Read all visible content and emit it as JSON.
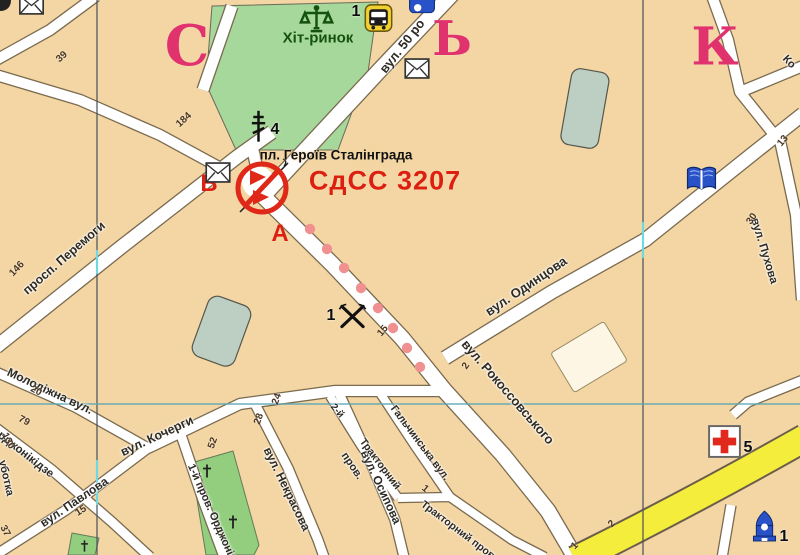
{
  "map": {
    "code_label": "СдСС 3207",
    "point_letters": {
      "a": "А",
      "b": "В"
    },
    "square_label": "пл. Героїв Сталінграда",
    "market_label": "Хіт-ринок",
    "grid_letters": [
      {
        "text": "С",
        "x": 187,
        "y": 46,
        "size": 56
      },
      {
        "text": "Ь",
        "x": 452,
        "y": 39,
        "size": 48
      },
      {
        "text": "К",
        "x": 715,
        "y": 47,
        "size": 52
      }
    ],
    "street_labels": [
      {
        "text": "вул. 50 ро",
        "x": 402,
        "y": 46,
        "rot": -52,
        "size": 13
      },
      {
        "text": "вул. Одинцова",
        "x": 526,
        "y": 286,
        "rot": -34,
        "size": 13
      },
      {
        "text": "вул. Рокоссовського",
        "x": 508,
        "y": 392,
        "rot": 49,
        "size": 13
      },
      {
        "text": "просп. Перемоги",
        "x": 64,
        "y": 258,
        "rot": -41,
        "size": 12.5
      },
      {
        "text": "Молодіжна вул.",
        "x": 50,
        "y": 391,
        "rot": 25,
        "size": 12
      },
      {
        "text": "вул. Кочерги",
        "x": 157,
        "y": 436,
        "rot": -25,
        "size": 12.5
      },
      {
        "text": "вул. Павлова",
        "x": 74,
        "y": 502,
        "rot": -34,
        "size": 12
      },
      {
        "text": "Орджонікідзе",
        "x": 22,
        "y": 452,
        "rot": 38,
        "size": 11.5
      },
      {
        "text": "уботка",
        "x": 6,
        "y": 478,
        "rot": 77,
        "size": 11
      },
      {
        "text": "1-й пров. Орджонікідзе",
        "x": 216,
        "y": 522,
        "rot": 66,
        "size": 11
      },
      {
        "text": "вул. Некрасова",
        "x": 287,
        "y": 489,
        "rot": 64,
        "size": 12
      },
      {
        "text": "вул. Осипова",
        "x": 381,
        "y": 487,
        "rot": 65,
        "size": 12
      },
      {
        "text": "пров.",
        "x": 352,
        "y": 466,
        "rot": 56,
        "size": 11
      },
      {
        "text": "2-й",
        "x": 337,
        "y": 411,
        "rot": 50,
        "size": 10
      },
      {
        "text": "Тракторний",
        "x": 380,
        "y": 464,
        "rot": 53,
        "size": 10.5
      },
      {
        "text": "Гальчинська вул.",
        "x": 420,
        "y": 443,
        "rot": 53,
        "size": 10.5
      },
      {
        "text": "Тракторний пров.",
        "x": 459,
        "y": 531,
        "rot": 37,
        "size": 10.5
      },
      {
        "text": "вул. Пухова",
        "x": 764,
        "y": 251,
        "rot": 73,
        "size": 11.5
      },
      {
        "text": "Ко",
        "x": 789,
        "y": 62,
        "rot": 47,
        "size": 11
      }
    ],
    "house_numbers": [
      {
        "text": "39",
        "x": 62,
        "y": 57,
        "rot": -42
      },
      {
        "text": "184",
        "x": 184,
        "y": 120,
        "rot": -42
      },
      {
        "text": "146",
        "x": 17,
        "y": 269,
        "rot": -47
      },
      {
        "text": "20",
        "x": 36,
        "y": 391,
        "rot": 28
      },
      {
        "text": "79",
        "x": 24,
        "y": 421,
        "rot": 28
      },
      {
        "text": "130",
        "x": 8,
        "y": 441,
        "rot": 62
      },
      {
        "text": "37",
        "x": 5,
        "y": 531,
        "rot": 62
      },
      {
        "text": "15",
        "x": 81,
        "y": 511,
        "rot": -33
      },
      {
        "text": "24",
        "x": 277,
        "y": 399,
        "rot": -70
      },
      {
        "text": "28",
        "x": 259,
        "y": 419,
        "rot": -70
      },
      {
        "text": "52",
        "x": 213,
        "y": 443,
        "rot": -70
      },
      {
        "text": "15",
        "x": 383,
        "y": 331,
        "rot": -50
      },
      {
        "text": "2",
        "x": 466,
        "y": 366,
        "rot": -55
      },
      {
        "text": "30",
        "x": 752,
        "y": 219,
        "rot": -55
      },
      {
        "text": "13",
        "x": 783,
        "y": 141,
        "rot": -50
      },
      {
        "text": "2",
        "x": 612,
        "y": 524,
        "rot": -45
      },
      {
        "text": "1",
        "x": 575,
        "y": 546,
        "rot": -45
      },
      {
        "text": "1",
        "x": 425,
        "y": 489,
        "rot": 40
      }
    ],
    "poi_numbers": [
      {
        "text": "1",
        "x": 356,
        "y": 12
      },
      {
        "text": "4",
        "x": 275,
        "y": 130
      },
      {
        "text": "1",
        "x": 331,
        "y": 316
      },
      {
        "text": "5",
        "x": 748,
        "y": 448
      },
      {
        "text": "1",
        "x": 784,
        "y": 537
      }
    ],
    "icons": [
      {
        "name": "corner-symbol-fragment-icon",
        "sym": "frag",
        "x": 0,
        "y": 0,
        "w": 14,
        "h": 12
      },
      {
        "name": "envelope-icon",
        "sym": "envelope",
        "x": 19,
        "y": -6,
        "w": 25,
        "h": 21
      },
      {
        "name": "scales-icon",
        "sym": "scales",
        "x": 299,
        "y": 5,
        "w": 35,
        "h": 29
      },
      {
        "name": "bus-icon",
        "sym": "bus",
        "x": 364,
        "y": 4,
        "w": 29,
        "h": 28
      },
      {
        "name": "transit-icon",
        "sym": "transit",
        "x": 409,
        "y": -5,
        "w": 26,
        "h": 19
      },
      {
        "name": "envelope-icon",
        "sym": "envelope",
        "x": 404,
        "y": 58,
        "w": 26,
        "h": 21
      },
      {
        "name": "envelope-icon",
        "sym": "envelope",
        "x": 205,
        "y": 162,
        "w": 26,
        "h": 21
      },
      {
        "name": "church-cross-icon",
        "sym": "church",
        "x": 249,
        "y": 109,
        "w": 19,
        "h": 35
      },
      {
        "name": "pickaxes-icon",
        "sym": "pickaxes",
        "x": 338,
        "y": 303,
        "w": 29,
        "h": 27
      },
      {
        "name": "hospital-icon",
        "sym": "hospital",
        "x": 708,
        "y": 425,
        "w": 33,
        "h": 33
      },
      {
        "name": "book-icon",
        "sym": "book",
        "x": 686,
        "y": 164,
        "w": 31,
        "h": 30
      },
      {
        "name": "dome-icon",
        "sym": "dome",
        "x": 752,
        "y": 510,
        "w": 25,
        "h": 35
      },
      {
        "name": "grave-cross-icon",
        "sym": "gcross",
        "x": 202,
        "y": 464,
        "w": 10,
        "h": 14
      },
      {
        "name": "grave-cross-icon",
        "sym": "gcross",
        "x": 228,
        "y": 515,
        "w": 10,
        "h": 14
      },
      {
        "name": "grave-cross-icon",
        "sym": "gcross",
        "x": 80,
        "y": 540,
        "w": 9,
        "h": 12
      }
    ],
    "colors": {
      "background": "#f3d6a3",
      "street_fill": "#ffffff",
      "street_casing": "#7a6a4f",
      "green_area": "#a7d89b",
      "cemetery_green": "#93ce7f",
      "building": "#bccfc2",
      "yellow_road": "#f4ed3c",
      "marker_red": "#e02818",
      "text_red": "#dd1f10",
      "grid_letter_pink": "#e0336e",
      "dotted_line": "#f09090",
      "icon_blue": "#2a52c8"
    }
  }
}
